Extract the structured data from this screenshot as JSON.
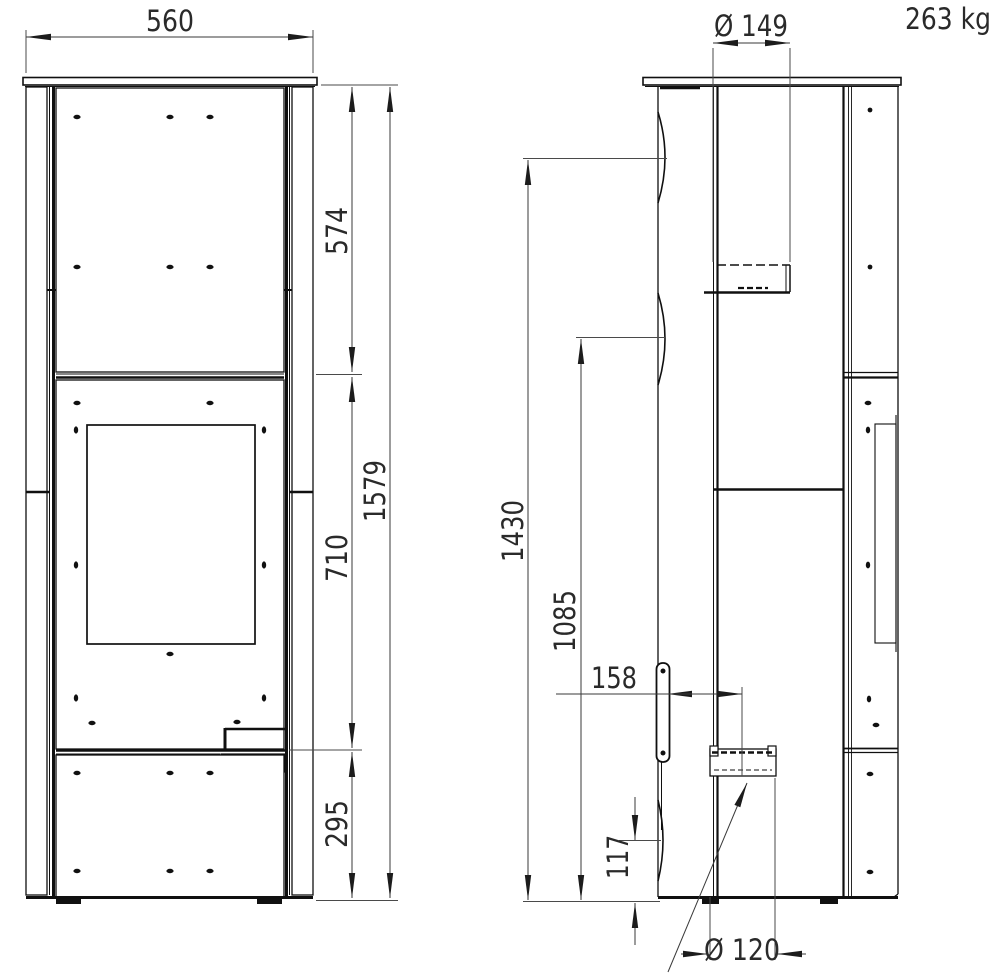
{
  "labels": {
    "weight": "263 kg"
  },
  "front_view": {
    "width": "560",
    "upper_height": "574",
    "door_height": "710",
    "base_height": "295",
    "total_height": "1579"
  },
  "side_view": {
    "flue_diameter": "Ø 149",
    "flue_center_height": "1430",
    "upper_connector_height": "1085",
    "handle_to_outlet_offset": "158",
    "inlet_height": "117",
    "inlet_diameter": "Ø 120"
  }
}
